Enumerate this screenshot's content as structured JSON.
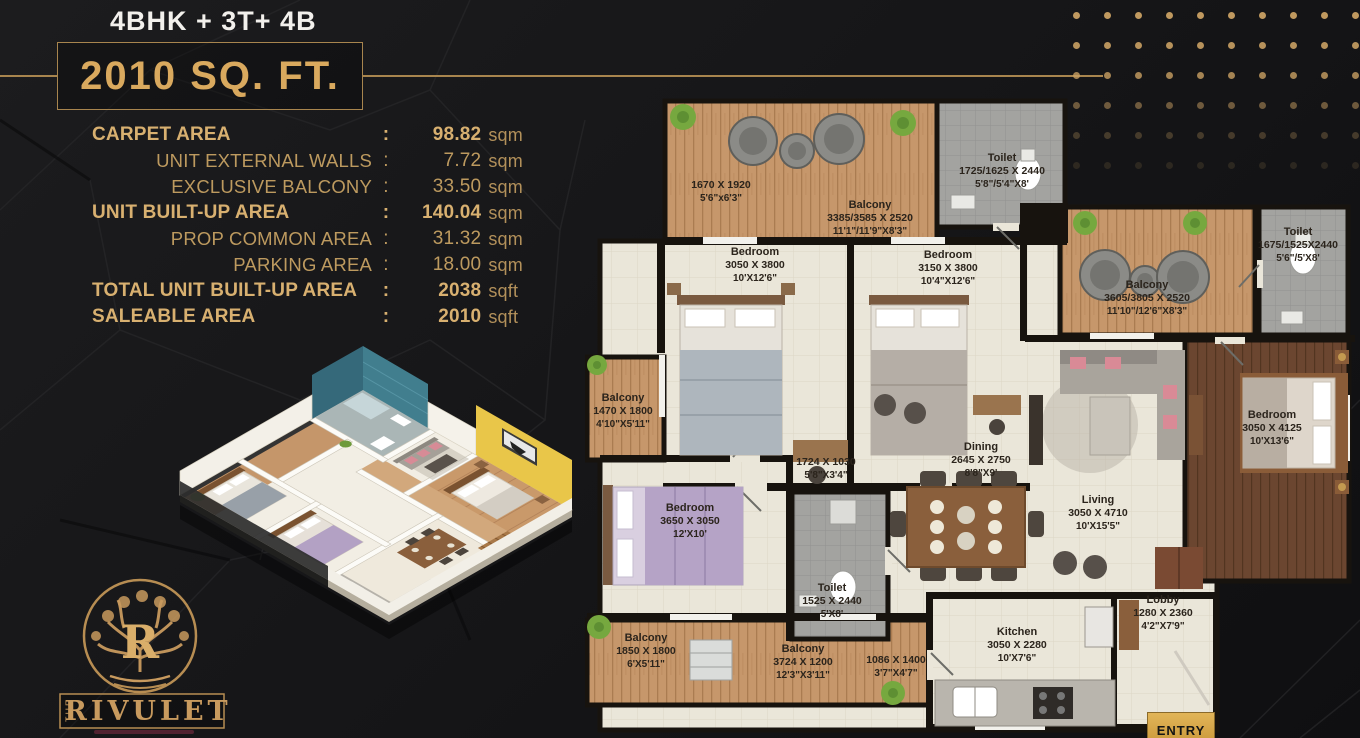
{
  "header": {
    "config_title": "4BHK + 3T+ 4B",
    "area_badge": "2010 SQ. FT."
  },
  "area_table": {
    "rows": [
      {
        "label": "CARPET AREA",
        "colon": ":",
        "value": "98.82",
        "unit": "sqm",
        "bold": true,
        "indent": false
      },
      {
        "label": "UNIT EXTERNAL WALLS",
        "colon": ":",
        "value": "7.72",
        "unit": "sqm",
        "bold": false,
        "indent": true
      },
      {
        "label": "EXCLUSIVE BALCONY",
        "colon": ":",
        "value": "33.50",
        "unit": "sqm",
        "bold": false,
        "indent": true
      },
      {
        "label": "UNIT BUILT-UP AREA",
        "colon": ":",
        "value": "140.04",
        "unit": "sqm",
        "bold": true,
        "indent": false
      },
      {
        "label": "PROP COMMON AREA",
        "colon": ":",
        "value": "31.32",
        "unit": "sqm",
        "bold": false,
        "indent": true
      },
      {
        "label": "PARKING AREA",
        "colon": ":",
        "value": "18.00",
        "unit": "sqm",
        "bold": false,
        "indent": true
      },
      {
        "label": "TOTAL UNIT BUILT-UP AREA",
        "colon": ":",
        "value": "2038",
        "unit": "sqft",
        "bold": true,
        "indent": false
      },
      {
        "label": "SALEABLE AREA",
        "colon": ":",
        "value": "2010",
        "unit": "sqft",
        "bold": true,
        "indent": false
      }
    ]
  },
  "floor_plan": {
    "entry_label": "ENTRY",
    "rooms": [
      {
        "name": "",
        "mm": "1670 X 1920",
        "ft": "5'6\"x6'3\"",
        "x": 136,
        "y": 84
      },
      {
        "name": "Balcony",
        "mm": "3385/3585 X 2520",
        "ft": "11'1\"/11'9\"X8'3\"",
        "x": 285,
        "y": 104
      },
      {
        "name": "Toilet",
        "mm": "1725/1625 X 2440",
        "ft": "5'8\"/5'4\"X8'",
        "x": 417,
        "y": 57
      },
      {
        "name": "Bedroom",
        "mm": "3050 X 3800",
        "ft": "10'X12'6\"",
        "x": 170,
        "y": 151
      },
      {
        "name": "Bedroom",
        "mm": "3150 X 3800",
        "ft": "10'4\"X12'6\"",
        "x": 363,
        "y": 154
      },
      {
        "name": "Balcony",
        "mm": "3605/3805 X 2520",
        "ft": "11'10\"/12'6\"X8'3\"",
        "x": 562,
        "y": 184
      },
      {
        "name": "Toilet",
        "mm": "1675/1525X2440",
        "ft": "5'6\"/5'X8'",
        "x": 713,
        "y": 131
      },
      {
        "name": "Balcony",
        "mm": "1470 X 1800",
        "ft": "4'10\"X5'11\"",
        "x": 38,
        "y": 297
      },
      {
        "name": "",
        "mm": "1724 X 1030",
        "ft": "5'8\"X3'4\"",
        "x": 241,
        "y": 361
      },
      {
        "name": "Dining",
        "mm": "2645 X 2750",
        "ft": "8'8\"X9'",
        "x": 396,
        "y": 346
      },
      {
        "name": "Living",
        "mm": "3050 X 4710",
        "ft": "10'X15'5\"",
        "x": 513,
        "y": 399
      },
      {
        "name": "Bedroom",
        "mm": "3050 X 4125",
        "ft": "10'X13'6\"",
        "x": 687,
        "y": 314
      },
      {
        "name": "Bedroom",
        "mm": "3650 X 3050",
        "ft": "12'X10'",
        "x": 105,
        "y": 407
      },
      {
        "name": "Toilet",
        "mm": "1525 X 2440",
        "ft": "5'X8'",
        "x": 247,
        "y": 487
      },
      {
        "name": "Balcony",
        "mm": "1850 X 1800",
        "ft": "6'X5'11\"",
        "x": 61,
        "y": 537
      },
      {
        "name": "Balcony",
        "mm": "3724 X 1200",
        "ft": "12'3\"X3'11\"",
        "x": 218,
        "y": 548
      },
      {
        "name": "",
        "mm": "1086 X 1400",
        "ft": "3'7\"X4'7\"",
        "x": 311,
        "y": 559
      },
      {
        "name": "Kitchen",
        "mm": "3050 X 2280",
        "ft": "10'X7'6\"",
        "x": 432,
        "y": 531
      },
      {
        "name": "Lobby",
        "mm": "1280 X 2360",
        "ft": "4'2\"X7'9\"",
        "x": 578,
        "y": 499
      }
    ]
  },
  "logo": {
    "brand_the": "THE",
    "brand_name": "RIVULET",
    "monogram": "R"
  },
  "colors": {
    "gold": "#c9a063",
    "line_gold": "#a8854e",
    "title_white": "#f2f0ec",
    "plan_floor": "#eae6d9",
    "plan_wood": "#c6976b",
    "plan_dark_wood": "#6b4630",
    "plan_tile_gray": "#a3a3a0",
    "wall_black": "#17130e"
  }
}
